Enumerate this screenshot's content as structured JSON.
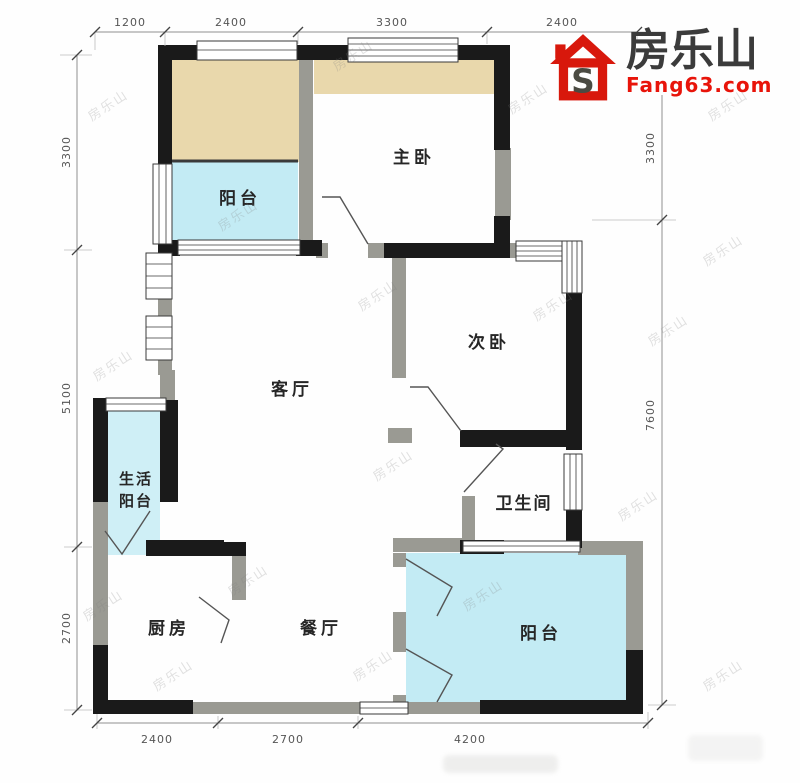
{
  "logo": {
    "brand": "房乐山",
    "domain": "Fang63.com"
  },
  "watermark": {
    "text": "房乐山"
  },
  "floorplan": {
    "rooms": {
      "balcony_top": "阳台",
      "master_bedroom": "主卧",
      "second_bedroom": "次卧",
      "living_room": "客厅",
      "utility_balcony_line1": "生活",
      "utility_balcony_line2": "阳台",
      "bathroom": "卫生间",
      "kitchen": "厨房",
      "dining_room": "餐厅",
      "balcony_bottom": "阳台"
    },
    "dimensions_mm": {
      "top": [
        "1200",
        "2400",
        "3300",
        "2400"
      ],
      "left": [
        "3300",
        "5100",
        "2700"
      ],
      "right": [
        "3300",
        "7600"
      ],
      "bottom": [
        "2400",
        "2700",
        "4200"
      ]
    },
    "colors": {
      "wall_black": "#1a1a1a",
      "wall_gray": "#9a9a93",
      "balcony_fill": "#c3ebf4",
      "utility_balcony_fill": "#cfeff6",
      "bay_window_fill": "#e9d8ac",
      "logo_red": "#e8140a",
      "logo_dark": "#3b3b3b"
    }
  }
}
